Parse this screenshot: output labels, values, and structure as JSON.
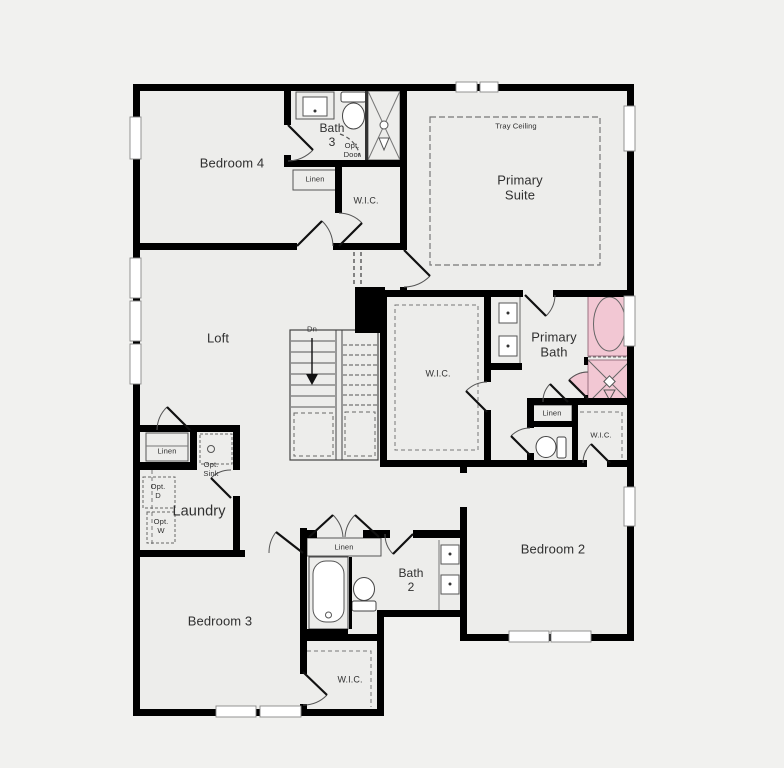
{
  "title": "Second floor plan",
  "colors": {
    "wall": "#000000",
    "accent": "#f2c7d3",
    "background": "#f1f1ef",
    "floor": "#ededeb",
    "line": "#555555",
    "text": "#303030"
  },
  "labels": {
    "bedroom4": "Bedroom 4",
    "bath3": "Bath\n3",
    "opt_door": "Opt.\nDoor",
    "linen_bath3": "Linen",
    "wic_bath3": "W.I.C.",
    "tray_ceiling": "Tray Ceiling",
    "primary_suite": "Primary\nSuite",
    "loft": "Loft",
    "down": "Dn",
    "wic_primary": "W.I.C.",
    "primary_bath": "Primary\nBath",
    "linen_primary": "Linen",
    "wic_bedroom2": "W.I.C.",
    "linen_loft": "Linen",
    "opt_sink": "Opt.\nSink",
    "opt_dryer": "Opt.\nD",
    "opt_washer": "Opt.\nW",
    "laundry": "Laundry",
    "bedroom3": "Bedroom 3",
    "linen_hall": "Linen",
    "bath2": "Bath\n2",
    "bedroom2": "Bedroom 2",
    "wic_bedroom3": "W.I.C."
  }
}
